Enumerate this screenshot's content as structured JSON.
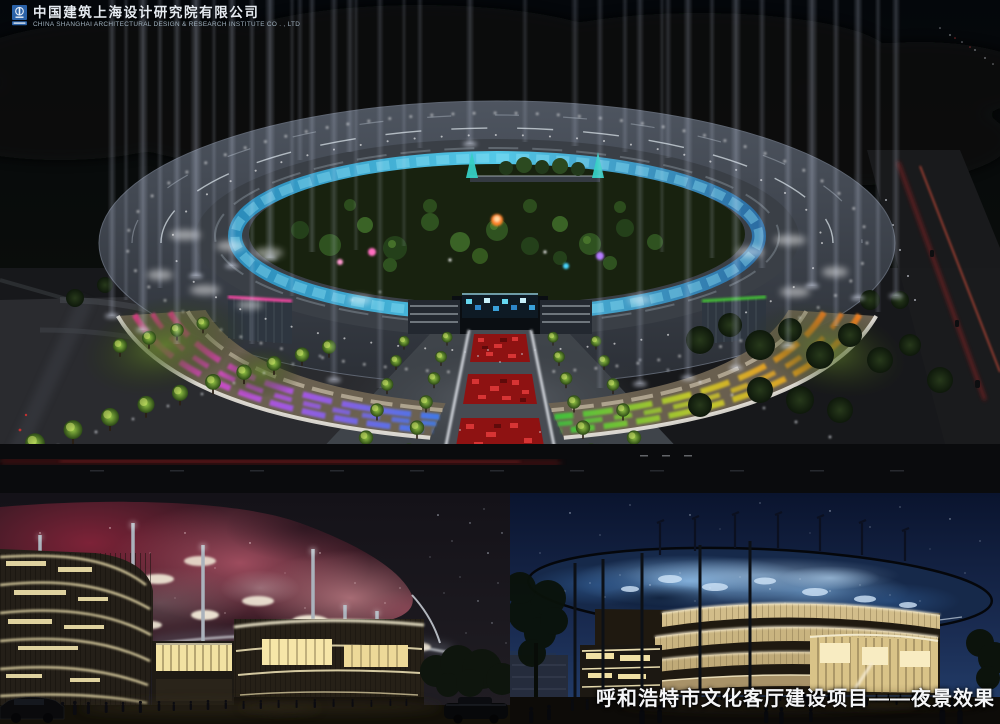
{
  "branding": {
    "icon": "cscec-blue-square-emblem",
    "company_zh": "中国建筑上海设计研究院有限公司",
    "company_en": "CHINA SHANGHAI ARCHITECTURAL DESIGN & RESEARCH INSTITUTE CO . , LTD"
  },
  "caption": {
    "text": "呼和浩特市文化客厅建设项目——夜景效果"
  },
  "palette": {
    "logo_blue": "#2b62a8",
    "beam_white": "#dde6ff",
    "inner_ring_cyan": "#55d0f0",
    "facade_left_gradient": [
      "#ff3d9e",
      "#a557e8",
      "#3f7bf0"
    ],
    "facade_right_gradient": [
      "#3ec43c",
      "#c6cc2a",
      "#ff8420"
    ],
    "walkway_red": "#a81616",
    "lit_tree_green": "#93c445",
    "nebula_canopy_pink": "#c06878",
    "galaxy_canopy_blue": "#7fb2e2",
    "caption_white": "#f5f6f8"
  }
}
